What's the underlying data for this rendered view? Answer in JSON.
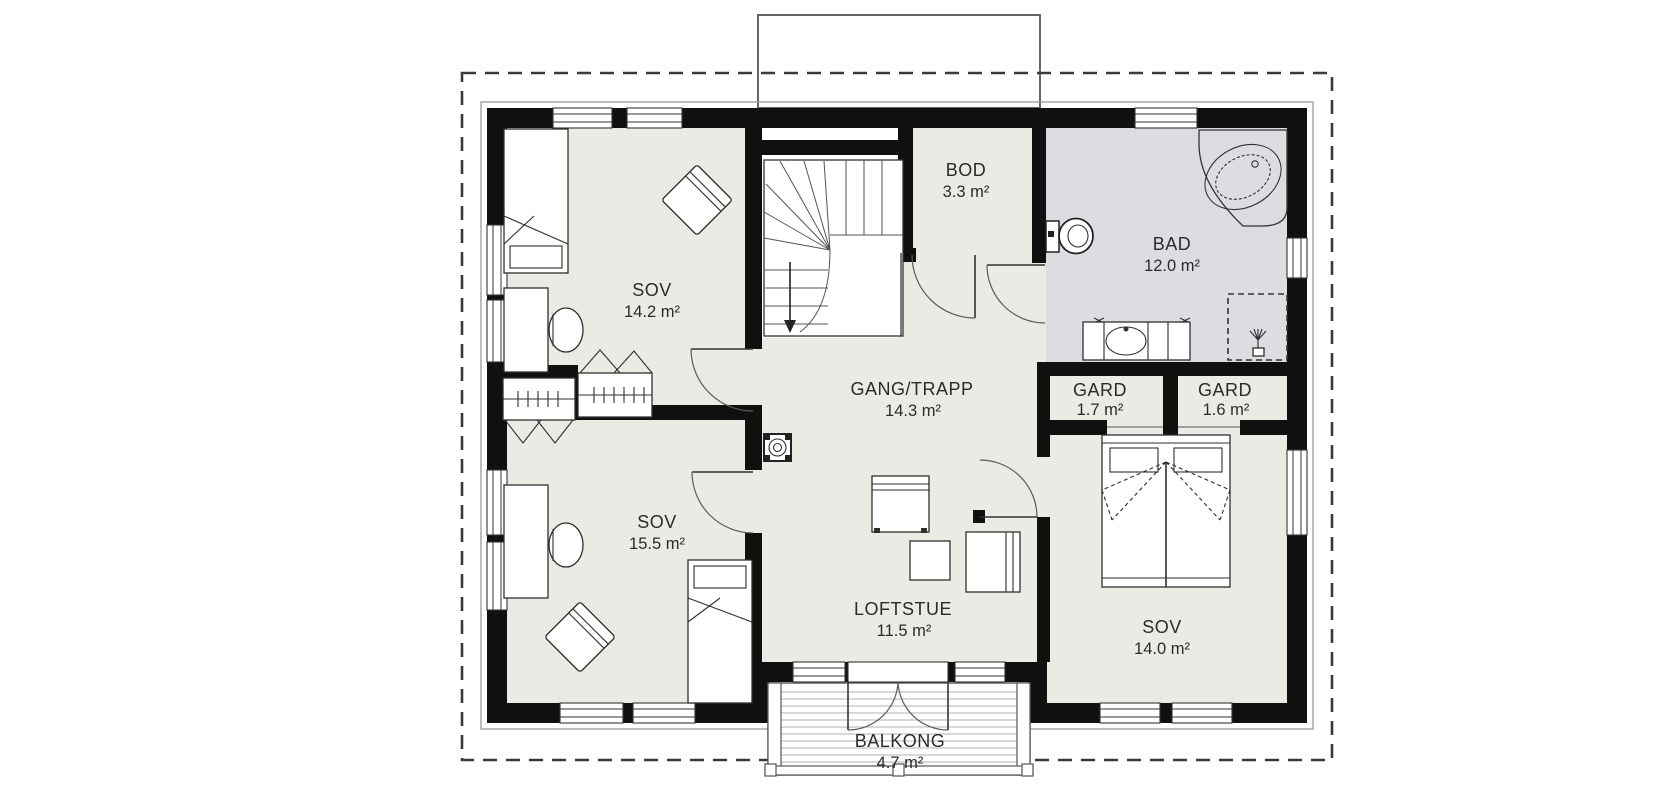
{
  "plan": {
    "rooms": [
      {
        "id": "sov-14-2",
        "name": "SOV",
        "area": "14.2 m²"
      },
      {
        "id": "sov-15-5",
        "name": "SOV",
        "area": "15.5 m²"
      },
      {
        "id": "gang-trapp",
        "name": "GANG/TRAPP",
        "area": "14.3 m²"
      },
      {
        "id": "loftstue",
        "name": "LOFTSTUE",
        "area": "11.5 m²"
      },
      {
        "id": "bod",
        "name": "BOD",
        "area": "3.3 m²"
      },
      {
        "id": "bad",
        "name": "BAD",
        "area": "12.0 m²"
      },
      {
        "id": "gard-1-7",
        "name": "GARD",
        "area": "1.7 m²"
      },
      {
        "id": "gard-1-6",
        "name": "GARD",
        "area": "1.6 m²"
      },
      {
        "id": "sov-14-0",
        "name": "SOV",
        "area": "14.0 m²"
      },
      {
        "id": "balkong",
        "name": "BALKONG",
        "area": "4.7 m²"
      }
    ],
    "fixtures": [
      "staircase-down",
      "chimney-vent",
      "bathtub",
      "toilet",
      "vanity-sink",
      "shower",
      "double-bed",
      "single-bed",
      "desk",
      "desk-chair",
      "lounge-chair",
      "wardrobe-hangers",
      "sofa",
      "armchair",
      "side-table",
      "balcony-deck",
      "french-doors"
    ],
    "colors": {
      "floor": "#ECEAE4",
      "bathroom_floor": "#DBDDE0",
      "wall": "#101010",
      "line": "#333333",
      "deck_plank": "#b3b3b3",
      "boundary": "#3a3a3a"
    }
  }
}
